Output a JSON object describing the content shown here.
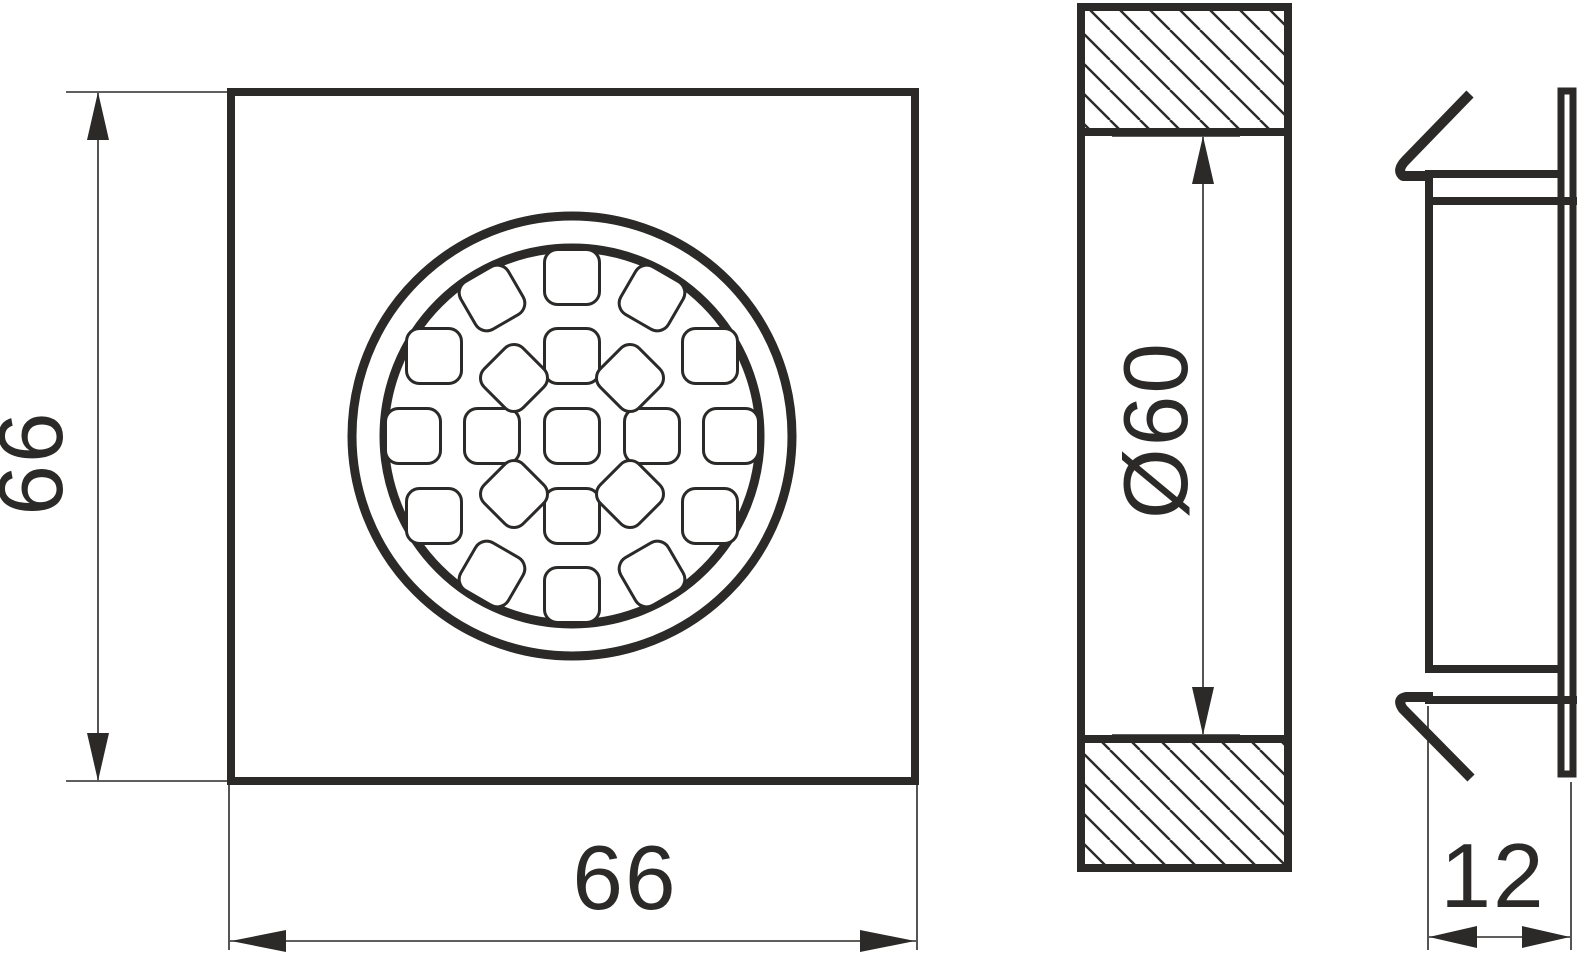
{
  "drawing": {
    "type": "technical-drawing",
    "subject": "recessed-led-downlight",
    "units_shown": "mm",
    "colors": {
      "line": "#2b2a29",
      "background": "#ffffff"
    },
    "views": {
      "front": {
        "name": "front-view",
        "height_label": "66",
        "width_label": "66",
        "led_count": 21
      },
      "section": {
        "name": "section-view",
        "diameter_label": "Ø60",
        "hatch_direction": "diagonal-top-left-to-bottom-right"
      },
      "side": {
        "name": "side-profile-view",
        "depth_label": "12",
        "features": [
          "spring-clip-top",
          "spring-clip-bottom",
          "front-bezel-lip"
        ]
      }
    },
    "leds": {
      "center_x": 572,
      "center_y": 436,
      "size": 55,
      "corner_radius": 13,
      "offsets": [
        {
          "dx": 0,
          "dy": 0,
          "rot": 0
        },
        {
          "dx": -80,
          "dy": 0,
          "rot": 0
        },
        {
          "dx": 80,
          "dy": 0,
          "rot": 0
        },
        {
          "dx": -159,
          "dy": 0,
          "rot": 0
        },
        {
          "dx": 159,
          "dy": 0,
          "rot": 0
        },
        {
          "dx": 0,
          "dy": -80,
          "rot": 0
        },
        {
          "dx": 0,
          "dy": 80,
          "rot": 0
        },
        {
          "dx": 0,
          "dy": -159,
          "rot": 0
        },
        {
          "dx": 0,
          "dy": 159,
          "rot": 0
        },
        {
          "dx": -58,
          "dy": -58,
          "rot": 45
        },
        {
          "dx": 58,
          "dy": -58,
          "rot": 45
        },
        {
          "dx": -58,
          "dy": 58,
          "rot": 45
        },
        {
          "dx": 58,
          "dy": 58,
          "rot": 45
        },
        {
          "dx": -138,
          "dy": -80,
          "rot": 0
        },
        {
          "dx": 138,
          "dy": -80,
          "rot": 0
        },
        {
          "dx": -138,
          "dy": 80,
          "rot": 0
        },
        {
          "dx": 138,
          "dy": 80,
          "rot": 0
        },
        {
          "dx": -80,
          "dy": -138,
          "rot": -30
        },
        {
          "dx": 80,
          "dy": -138,
          "rot": 30
        },
        {
          "dx": -80,
          "dy": 138,
          "rot": 30
        },
        {
          "dx": 80,
          "dy": 138,
          "rot": -30
        }
      ]
    }
  }
}
